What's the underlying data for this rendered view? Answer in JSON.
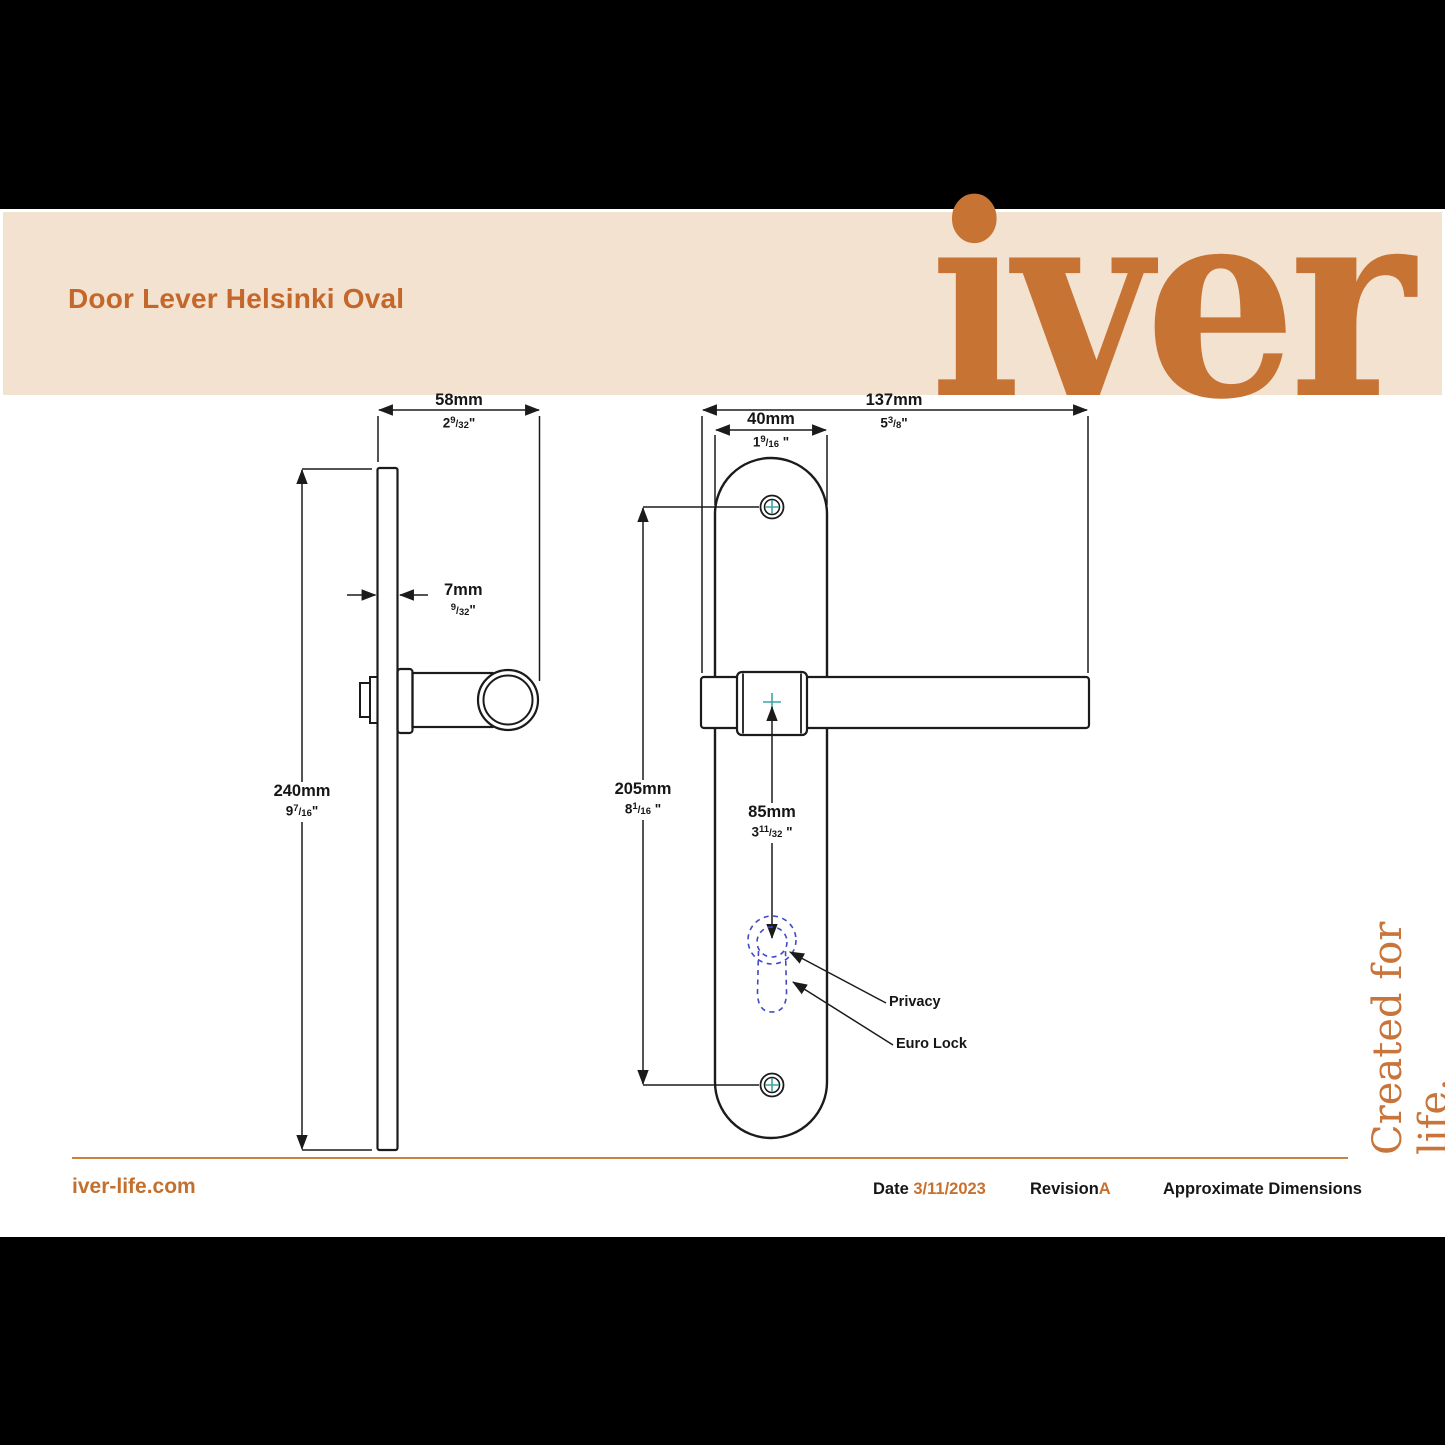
{
  "header": {
    "title": "Door Lever Helsinki Oval",
    "logo_text": "iver"
  },
  "tagline": "Created for life.",
  "side_view": {
    "width_dim": {
      "mm": "58mm",
      "in": {
        "whole": "2",
        "num": "9",
        "slash": "/",
        "den": "32",
        "quote": "\""
      }
    },
    "thickness_dim": {
      "mm": "7mm",
      "in": {
        "whole": "",
        "num": "9",
        "slash": "/",
        "den": "32",
        "quote": "\""
      }
    },
    "height_dim": {
      "mm": "240mm",
      "in": {
        "whole": "9",
        "num": "7",
        "slash": "/",
        "den": "16",
        "quote": "\""
      }
    }
  },
  "front_view": {
    "length_dim": {
      "mm": "137mm",
      "in": {
        "whole": "5",
        "num": "3",
        "slash": "/",
        "den": "8",
        "quote": "\""
      }
    },
    "plate_width_dim": {
      "mm": "40mm",
      "in": {
        "whole": "1",
        "num": "9",
        "slash": "/",
        "den": "16",
        "quote": " \""
      }
    },
    "centres_dim": {
      "mm": "205mm",
      "in": {
        "whole": "8",
        "num": "1",
        "slash": "/",
        "den": "16",
        "quote": " \""
      }
    },
    "lock_centre_dim": {
      "mm": "85mm",
      "in": {
        "whole": "3",
        "num": "11",
        "slash": "/",
        "den": "32",
        "quote": " \""
      }
    },
    "labels": {
      "privacy": "Privacy",
      "euro_lock": "Euro Lock"
    }
  },
  "footer": {
    "website": "iver-life.com",
    "date_label": "Date",
    "date_value": "3/11/2023",
    "revision_label": "Revision",
    "revision_value": "A",
    "note": "Approximate Dimensions"
  },
  "colors": {
    "accent_orange": "#c8702e",
    "logo_orange": "#c67334",
    "cream_band": "#f3e2d0",
    "centre_cross_teal": "#3aa7a3",
    "lock_dashed_blue": "#4149c8",
    "drawing_line": "#1b1b1b"
  }
}
